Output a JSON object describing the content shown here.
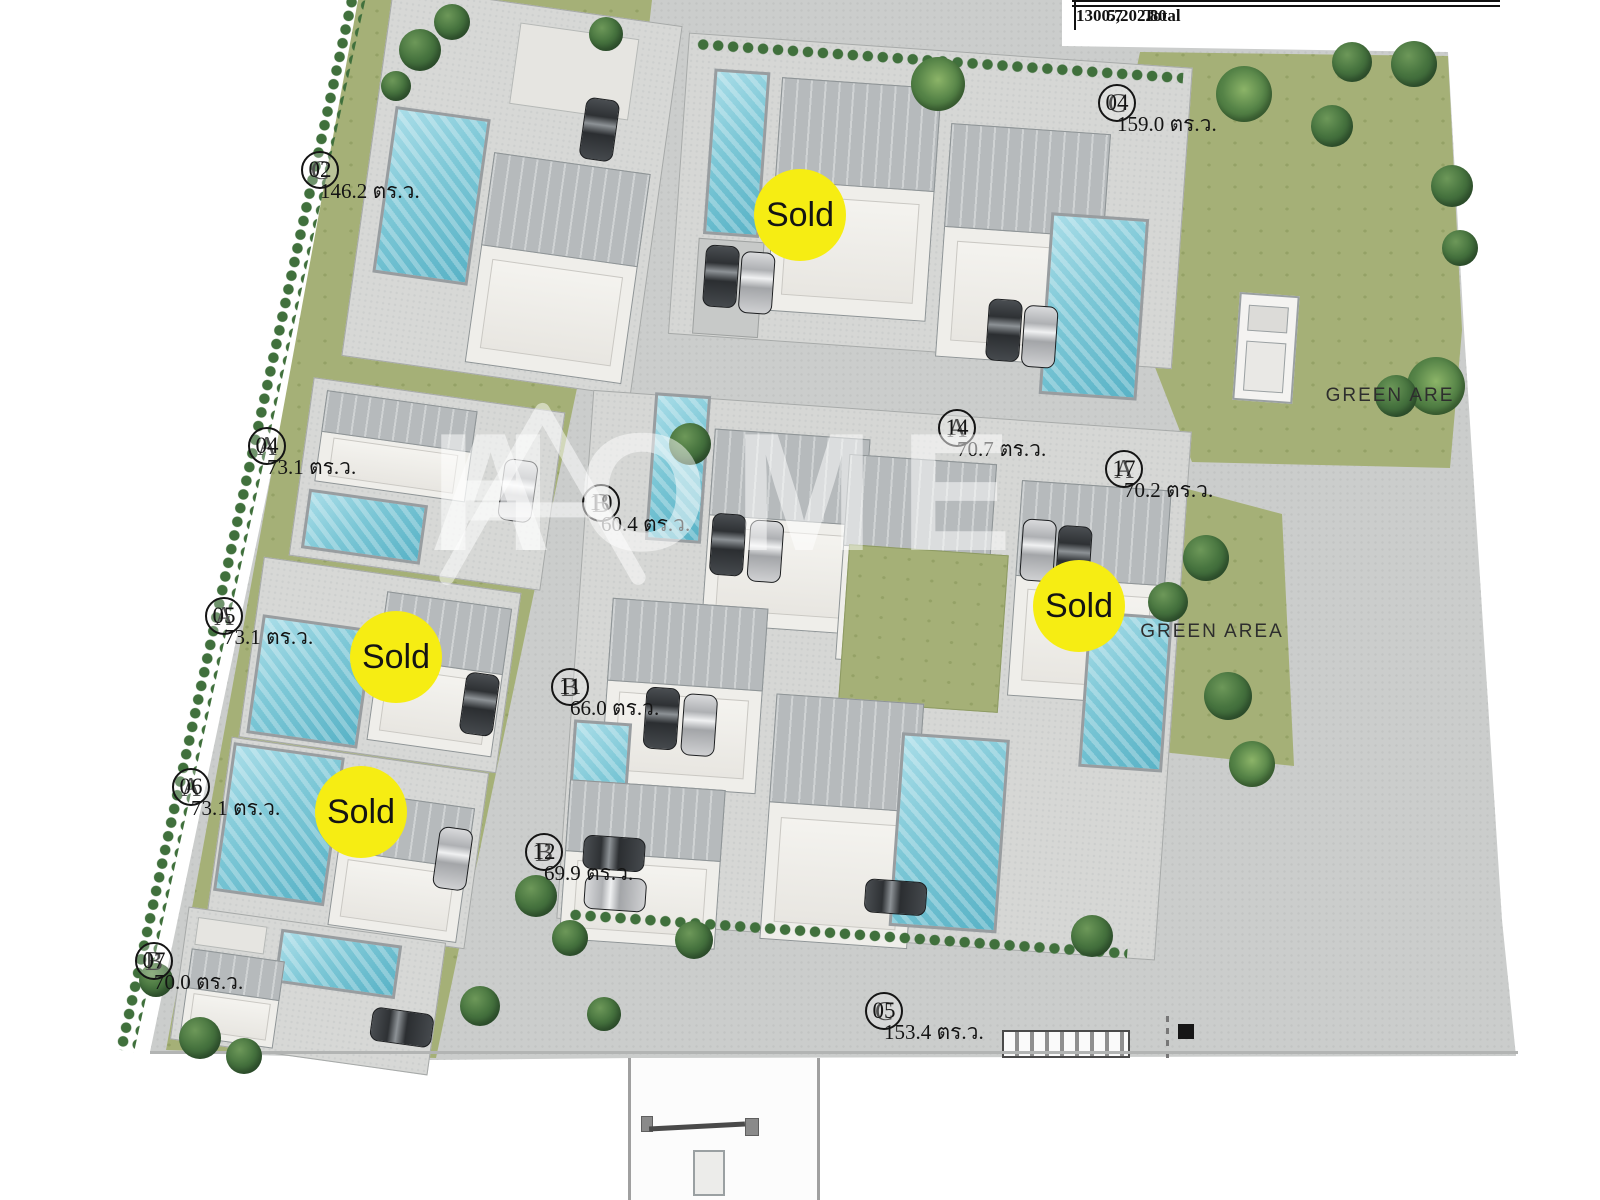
{
  "summary_table": {
    "clipped_row": [
      "C05",
      "TYPE C",
      "613.6",
      "153.4"
    ],
    "total_row": {
      "label": "Total",
      "total_sqm": "5,202.80",
      "total_wah": "1300.7"
    }
  },
  "units": [
    {
      "code": "C",
      "number": "02",
      "area": "146.2 ตร.ว.",
      "x": 320,
      "y": 170
    },
    {
      "code": "C",
      "number": "04",
      "area": "159.0 ตร.ว.",
      "x": 1117,
      "y": 103
    },
    {
      "code": "A",
      "number": "04",
      "area": "73.1 ตร.ว.",
      "x": 267,
      "y": 446
    },
    {
      "code": "A",
      "number": "05",
      "area": "73.1 ตร.ว.",
      "x": 224,
      "y": 616
    },
    {
      "code": "A",
      "number": "06",
      "area": "73.1 ตร.ว.",
      "x": 191,
      "y": 787
    },
    {
      "code": "B",
      "number": "07",
      "area": "70.0 ตร.ว.",
      "x": 154,
      "y": 961
    },
    {
      "code": "B",
      "number": "10",
      "area": "60.4 ตร.ว.",
      "x": 601,
      "y": 503
    },
    {
      "code": "B",
      "number": "11",
      "area": "66.0 ตร.ว.",
      "x": 570,
      "y": 687
    },
    {
      "code": "B",
      "number": "12",
      "area": "69.9 ตร.ว.",
      "x": 544,
      "y": 852
    },
    {
      "code": "A",
      "number": "14",
      "area": "70.7 ตร.ว.",
      "x": 957,
      "y": 428
    },
    {
      "code": "A",
      "number": "17",
      "area": "70.2 ตร.ว.",
      "x": 1124,
      "y": 469
    },
    {
      "code": "C",
      "number": "05",
      "area": "153.4 ตร.ว.",
      "x": 884,
      "y": 1011
    }
  ],
  "sold_badges": [
    {
      "label": "Sold",
      "x": 800,
      "y": 215
    },
    {
      "label": "Sold",
      "x": 396,
      "y": 657
    },
    {
      "label": "Sold",
      "x": 361,
      "y": 812
    },
    {
      "label": "Sold",
      "x": 1079,
      "y": 606
    }
  ],
  "green_labels": [
    {
      "text": "GREEN ARE",
      "x": 1390,
      "y": 396
    },
    {
      "text": "GREEN AREA",
      "x": 1212,
      "y": 632
    }
  ],
  "watermark": {
    "letter": "A",
    "word": "HOME"
  },
  "colors": {
    "sold_yellow": "#F6ED13",
    "lawn_green": "#A5B077",
    "road_gray": "#CBCDCC",
    "pool_blue": "#7CC7D6",
    "label_text": "#141414"
  }
}
